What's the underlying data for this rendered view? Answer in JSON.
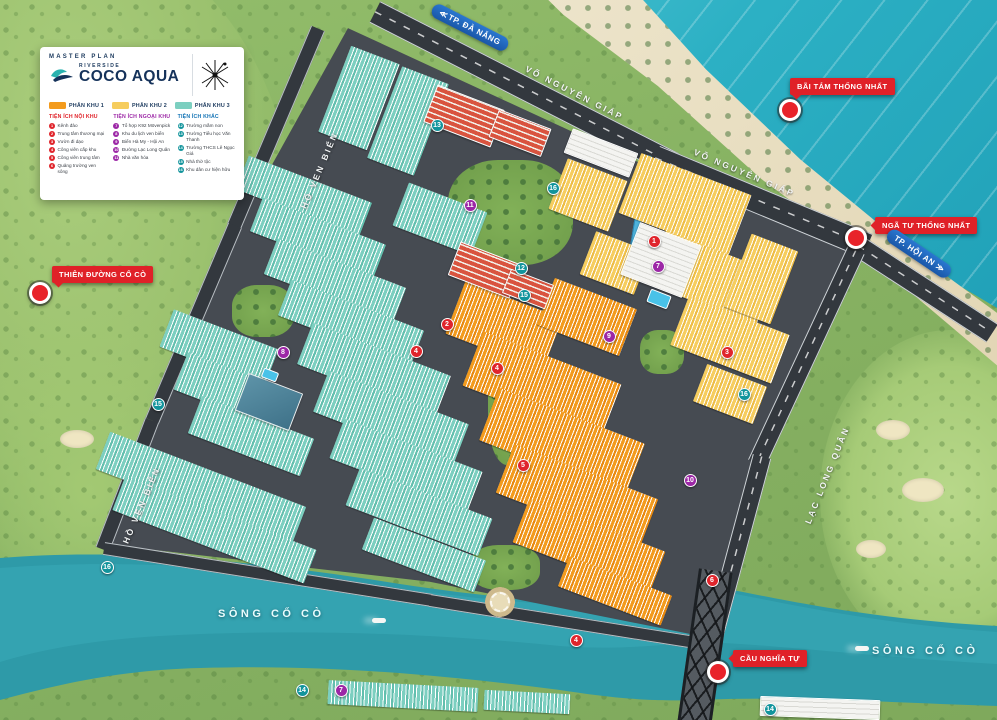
{
  "colors": {
    "phase1": "#f39b1d",
    "phase2": "#f6cd5e",
    "phase3": "#7ccfc0",
    "badge_red": "#e02128",
    "direction_blue": "#1a57a8",
    "marker_red": "#e0252c",
    "marker_purple": "#9c27a6",
    "marker_teal": "#12949c",
    "ocean": "#2cb0c4",
    "river": "#2e9aa8"
  },
  "legend": {
    "master_plan": "MASTER PLAN",
    "brand_top": "RIVERSIDE",
    "brand_main": "COCO AQUA",
    "phases": [
      {
        "label": "PHÂN KHU 1",
        "color": "#f39b1d"
      },
      {
        "label": "PHÂN KHU 2",
        "color": "#f6cd5e"
      },
      {
        "label": "PHÂN KHU 3",
        "color": "#7ccfc0"
      }
    ],
    "columns": [
      {
        "title": "TIỆN ÍCH NỘI KHU",
        "color": "#e02128",
        "dot": "#e0252c",
        "items": [
          {
            "n": "1",
            "label": "Kênh đào"
          },
          {
            "n": "2",
            "label": "Trung tâm thương mại"
          },
          {
            "n": "3",
            "label": "Vườn đi dạo"
          },
          {
            "n": "4",
            "label": "Công viên cấp khu"
          },
          {
            "n": "5",
            "label": "Công viên trung tâm"
          },
          {
            "n": "6",
            "label": "Quảng trường ven sông"
          }
        ]
      },
      {
        "title": "TIỆN ÍCH NGOẠI KHU",
        "color": "#9c27a6",
        "dot": "#9c27a6",
        "items": [
          {
            "n": "7",
            "label": "Tổ hợp K92 Mövenpick"
          },
          {
            "n": "8",
            "label": "Khu du lịch ven biển"
          },
          {
            "n": "9",
            "label": "Biển Hà My - Hội An"
          },
          {
            "n": "10",
            "label": "Đường Lạc Long Quân"
          },
          {
            "n": "11",
            "label": "Nhà văn hóa"
          }
        ]
      },
      {
        "title": "TIỆN ÍCH KHÁC",
        "color": "#1273b5",
        "dot": "#12949c",
        "items": [
          {
            "n": "12",
            "label": "Trường mầm non"
          },
          {
            "n": "13",
            "label": "Trường Tiểu học Văn Thanh"
          },
          {
            "n": "14",
            "label": "Trường THCS Lê Ngọc Giá"
          },
          {
            "n": "15",
            "label": "Nhà thờ tộc"
          },
          {
            "n": "16",
            "label": "Khu dân cư hiện hữu"
          }
        ]
      }
    ]
  },
  "labels": {
    "badges": [
      {
        "id": "bai-tam-thong-nhat",
        "text": "BÃI TẮM THỐNG NHẤT",
        "x": 790,
        "y": 78,
        "pointer": "pt-bl"
      },
      {
        "id": "nga-tu-thong-nhat",
        "text": "NGÃ TƯ THỐNG NHẤT",
        "x": 875,
        "y": 217,
        "pointer": "pt-l"
      },
      {
        "id": "thien-duong-co-co",
        "text": "THIÊN ĐƯỜNG CỔ CÒ",
        "x": 52,
        "y": 266,
        "pointer": "pt-bl"
      },
      {
        "id": "cau-nghia-tu",
        "text": "CẦU NGHĨA TỰ",
        "x": 733,
        "y": 650,
        "pointer": "pt-l"
      }
    ],
    "directions": [
      {
        "id": "tp-da-nang",
        "text": "TP. ĐÀ NẴNG",
        "chevrons": "≪",
        "side": "left",
        "x": 428,
        "y": 20,
        "rot": 27
      },
      {
        "id": "tp-hoi-an",
        "text": "TP. HỘI AN",
        "chevrons": "≫",
        "side": "right",
        "x": 882,
        "y": 246,
        "rot": 34
      }
    ],
    "roadnames": [
      {
        "text": "VÕ NGUYÊN GIÁP",
        "x": 520,
        "y": 88,
        "rot": 27
      },
      {
        "text": "VÕ NGUYÊN GIÁP",
        "x": 690,
        "y": 168,
        "rot": 23
      },
      {
        "text": "LẠC LONG QUÂN",
        "x": 775,
        "y": 470,
        "rot": -68
      },
      {
        "text": "HỒ VEN BIỂN",
        "x": 278,
        "y": 165,
        "rot": -67
      },
      {
        "text": "HỒ VEN BIỂN",
        "x": 100,
        "y": 500,
        "rot": -67
      }
    ],
    "rivers": [
      {
        "text": "SÔNG CỔ CÒ",
        "x": 218,
        "y": 608
      },
      {
        "text": "SÔNG CỔ CÒ",
        "x": 872,
        "y": 645
      }
    ]
  },
  "map": {
    "pois": [
      {
        "id": "poi-bai-tam",
        "x": 790,
        "y": 110
      },
      {
        "id": "poi-nga-tu",
        "x": 856,
        "y": 238
      },
      {
        "id": "poi-thien-duong",
        "x": 40,
        "y": 293
      },
      {
        "id": "poi-cau-nghia-tu",
        "x": 718,
        "y": 672
      }
    ],
    "markers": [
      {
        "x": 654,
        "y": 241,
        "c": "red",
        "n": "1"
      },
      {
        "x": 447,
        "y": 324,
        "c": "red",
        "n": "2"
      },
      {
        "x": 727,
        "y": 352,
        "c": "red",
        "n": "3"
      },
      {
        "x": 497,
        "y": 368,
        "c": "red",
        "n": "4"
      },
      {
        "x": 416,
        "y": 351,
        "c": "red",
        "n": "4"
      },
      {
        "x": 523,
        "y": 465,
        "c": "red",
        "n": "5"
      },
      {
        "x": 576,
        "y": 640,
        "c": "red",
        "n": "4"
      },
      {
        "x": 712,
        "y": 580,
        "c": "red",
        "n": "6"
      },
      {
        "x": 341,
        "y": 690,
        "c": "purple",
        "n": "7"
      },
      {
        "x": 658,
        "y": 266,
        "c": "purple",
        "n": "7"
      },
      {
        "x": 609,
        "y": 336,
        "c": "purple",
        "n": "9"
      },
      {
        "x": 283,
        "y": 352,
        "c": "purple",
        "n": "8"
      },
      {
        "x": 690,
        "y": 480,
        "c": "purple",
        "n": "10"
      },
      {
        "x": 470,
        "y": 205,
        "c": "purple",
        "n": "11"
      },
      {
        "x": 437,
        "y": 125,
        "c": "teal",
        "n": "13"
      },
      {
        "x": 521,
        "y": 268,
        "c": "teal",
        "n": "12"
      },
      {
        "x": 524,
        "y": 295,
        "c": "teal",
        "n": "15"
      },
      {
        "x": 553,
        "y": 188,
        "c": "teal",
        "n": "16"
      },
      {
        "x": 302,
        "y": 690,
        "c": "teal",
        "n": "14"
      },
      {
        "x": 770,
        "y": 709,
        "c": "teal",
        "n": "14"
      },
      {
        "x": 158,
        "y": 404,
        "c": "teal",
        "n": "15"
      },
      {
        "x": 107,
        "y": 567,
        "c": "teal",
        "n": "16"
      },
      {
        "x": 744,
        "y": 394,
        "c": "teal",
        "n": "16"
      }
    ],
    "roads": [
      {
        "x": 375,
        "y": 12,
        "len": 335,
        "w": 24,
        "rot": 27,
        "cls": ""
      },
      {
        "x": 655,
        "y": 158,
        "len": 230,
        "w": 26,
        "rot": 22.5,
        "cls": ""
      },
      {
        "x": 858,
        "y": 246,
        "len": 160,
        "w": 22,
        "rot": 33,
        "cls": ""
      },
      {
        "x": 856,
        "y": 250,
        "len": 235,
        "w": 19,
        "rot": 115,
        "cls": ""
      },
      {
        "x": 762,
        "y": 456,
        "len": 192,
        "w": 19,
        "rot": 105,
        "cls": ""
      },
      {
        "x": 318,
        "y": 28,
        "len": 215,
        "w": 15,
        "rot": 113,
        "cls": "minor"
      },
      {
        "x": 235,
        "y": 225,
        "len": 212,
        "w": 15,
        "rot": 113,
        "cls": "minor"
      },
      {
        "x": 152,
        "y": 420,
        "len": 138,
        "w": 15,
        "rot": 111,
        "cls": "minor"
      },
      {
        "x": 104,
        "y": 548,
        "len": 332,
        "w": 13,
        "rot": 9,
        "cls": "minor"
      },
      {
        "x": 430,
        "y": 600,
        "len": 262,
        "w": 13,
        "rot": 9,
        "cls": "minor"
      },
      {
        "x": 700,
        "y": 700,
        "len": 30,
        "w": 18,
        "rot": 100,
        "cls": "minor"
      }
    ],
    "canals": [
      {
        "x": 648,
        "y": 152,
        "len": 100,
        "w": 7,
        "rot": 99
      }
    ],
    "parks": [
      {
        "x": 448,
        "y": 160,
        "w": 125,
        "h": 105
      },
      {
        "x": 488,
        "y": 345,
        "w": 48,
        "h": 120
      },
      {
        "x": 232,
        "y": 285,
        "w": 62,
        "h": 52
      },
      {
        "x": 640,
        "y": 330,
        "w": 44,
        "h": 44
      },
      {
        "x": 470,
        "y": 545,
        "w": 70,
        "h": 45
      }
    ],
    "blocks": [
      {
        "x": 333,
        "y": 52,
        "w": 52,
        "h": 92,
        "rot": 21,
        "phase": "phase3"
      },
      {
        "x": 383,
        "y": 72,
        "w": 50,
        "h": 98,
        "rot": 21,
        "phase": "phase3"
      },
      {
        "x": 238,
        "y": 178,
        "w": 132,
        "h": 36,
        "rot": 21,
        "phase": "phase3"
      },
      {
        "x": 252,
        "y": 220,
        "w": 132,
        "h": 36,
        "rot": 21,
        "phase": "phase3"
      },
      {
        "x": 266,
        "y": 262,
        "w": 138,
        "h": 38,
        "rot": 21,
        "phase": "phase3"
      },
      {
        "x": 280,
        "y": 304,
        "w": 142,
        "h": 38,
        "rot": 21,
        "phase": "phase3"
      },
      {
        "x": 163,
        "y": 328,
        "w": 112,
        "h": 40,
        "rot": 21,
        "phase": "phase3"
      },
      {
        "x": 177,
        "y": 372,
        "w": 118,
        "h": 40,
        "rot": 21,
        "phase": "phase3"
      },
      {
        "x": 191,
        "y": 416,
        "w": 120,
        "h": 40,
        "rot": 21,
        "phase": "phase3"
      },
      {
        "x": 96,
        "y": 468,
        "w": 210,
        "h": 40,
        "rot": 21,
        "phase": "phase3"
      },
      {
        "x": 112,
        "y": 512,
        "w": 205,
        "h": 36,
        "rot": 21,
        "phase": "phase3"
      },
      {
        "x": 300,
        "y": 348,
        "w": 148,
        "h": 44,
        "rot": 21,
        "phase": "phase3"
      },
      {
        "x": 316,
        "y": 396,
        "w": 150,
        "h": 44,
        "rot": 21,
        "phase": "phase3"
      },
      {
        "x": 332,
        "y": 444,
        "w": 148,
        "h": 42,
        "rot": 21,
        "phase": "phase3"
      },
      {
        "x": 348,
        "y": 492,
        "w": 142,
        "h": 40,
        "rot": 21,
        "phase": "phase3"
      },
      {
        "x": 364,
        "y": 538,
        "w": 120,
        "h": 34,
        "rot": 21,
        "phase": "phase3"
      },
      {
        "x": 398,
        "y": 196,
        "w": 84,
        "h": 46,
        "rot": 21,
        "phase": "phase3"
      },
      {
        "x": 328,
        "y": 684,
        "w": 150,
        "h": 24,
        "rot": 3,
        "phase": "phase3"
      },
      {
        "x": 484,
        "y": 692,
        "w": 86,
        "h": 20,
        "rot": 3,
        "phase": "phase3"
      },
      {
        "x": 556,
        "y": 168,
        "w": 64,
        "h": 54,
        "rot": 21,
        "phase": "phase2"
      },
      {
        "x": 626,
        "y": 172,
        "w": 118,
        "h": 64,
        "rot": 21,
        "phase": "phase2"
      },
      {
        "x": 586,
        "y": 240,
        "w": 58,
        "h": 46,
        "rot": 21,
        "phase": "phase2"
      },
      {
        "x": 652,
        "y": 250,
        "w": 118,
        "h": 56,
        "rot": 21,
        "phase": "phase2"
      },
      {
        "x": 676,
        "y": 314,
        "w": 108,
        "h": 52,
        "rot": 21,
        "phase": "phase2"
      },
      {
        "x": 736,
        "y": 240,
        "w": 50,
        "h": 78,
        "rot": 21,
        "phase": "phase2"
      },
      {
        "x": 698,
        "y": 374,
        "w": 64,
        "h": 40,
        "rot": 21,
        "phase": "phase2"
      },
      {
        "x": 452,
        "y": 298,
        "w": 104,
        "h": 56,
        "rot": 21,
        "phase": "phase1"
      },
      {
        "x": 468,
        "y": 356,
        "w": 148,
        "h": 58,
        "rot": 21,
        "phase": "phase1"
      },
      {
        "x": 484,
        "y": 414,
        "w": 156,
        "h": 56,
        "rot": 21,
        "phase": "phase1"
      },
      {
        "x": 500,
        "y": 470,
        "w": 154,
        "h": 52,
        "rot": 21,
        "phase": "phase1"
      },
      {
        "x": 516,
        "y": 524,
        "w": 146,
        "h": 46,
        "rot": 21,
        "phase": "phase1"
      },
      {
        "x": 543,
        "y": 292,
        "w": 88,
        "h": 50,
        "rot": 21,
        "phase": "phase1"
      },
      {
        "x": 560,
        "y": 575,
        "w": 110,
        "h": 32,
        "rot": 21,
        "phase": "phase1"
      }
    ],
    "buildings": [
      {
        "x": 428,
        "y": 96,
        "w": 72,
        "h": 40,
        "rot": 21,
        "type": "red"
      },
      {
        "x": 492,
        "y": 118,
        "w": 56,
        "h": 30,
        "rot": 21,
        "type": "red"
      },
      {
        "x": 452,
        "y": 252,
        "w": 66,
        "h": 36,
        "rot": 21,
        "type": "red"
      },
      {
        "x": 505,
        "y": 276,
        "w": 46,
        "h": 26,
        "rot": 21,
        "type": "red"
      },
      {
        "x": 628,
        "y": 232,
        "w": 66,
        "h": 56,
        "rot": 21,
        "type": "white"
      },
      {
        "x": 648,
        "y": 292,
        "w": 22,
        "h": 14,
        "rot": 21,
        "type": "pool"
      },
      {
        "x": 240,
        "y": 382,
        "w": 58,
        "h": 40,
        "rot": 21,
        "type": "blue"
      },
      {
        "x": 262,
        "y": 370,
        "w": 16,
        "h": 10,
        "rot": 21,
        "type": "pool"
      },
      {
        "x": 760,
        "y": 698,
        "w": 120,
        "h": 20,
        "rot": 2,
        "type": "white"
      },
      {
        "x": 566,
        "y": 140,
        "w": 70,
        "h": 26,
        "rot": 21,
        "type": "white"
      }
    ],
    "bunkers": [
      {
        "x": 876,
        "y": 420,
        "w": 34,
        "h": 20
      },
      {
        "x": 902,
        "y": 478,
        "w": 42,
        "h": 24
      },
      {
        "x": 856,
        "y": 540,
        "w": 30,
        "h": 18
      },
      {
        "x": 190,
        "y": 120,
        "w": 30,
        "h": 16
      },
      {
        "x": 60,
        "y": 430,
        "w": 34,
        "h": 18
      }
    ],
    "boats": [
      {
        "x": 372,
        "y": 618
      },
      {
        "x": 855,
        "y": 646
      }
    ]
  }
}
